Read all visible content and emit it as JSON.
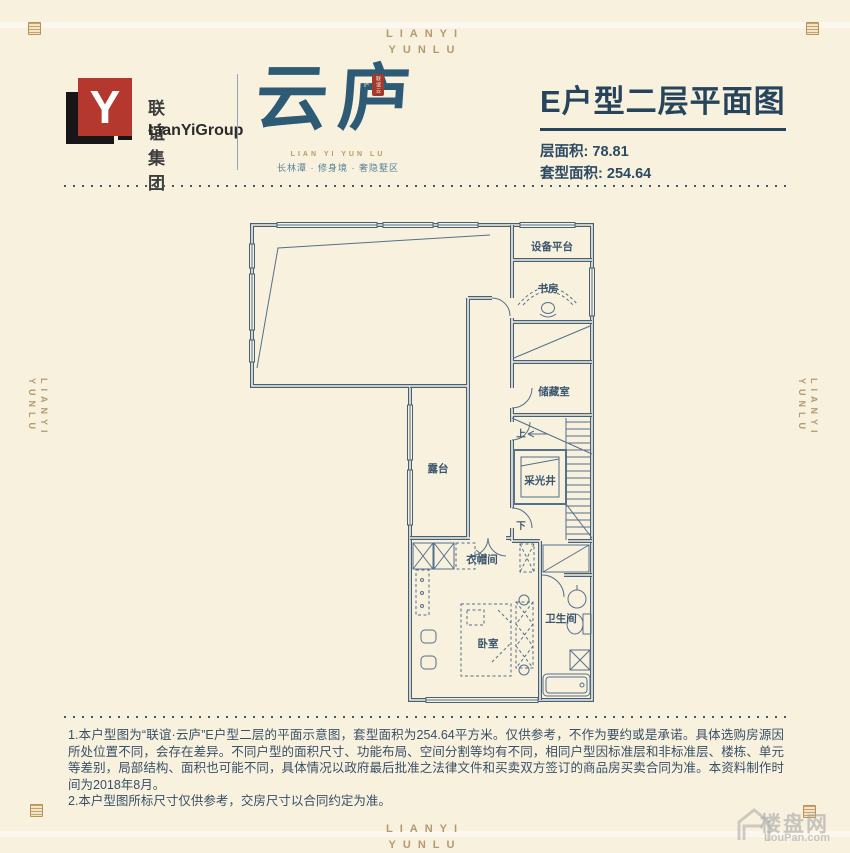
{
  "colors": {
    "background": "#f8f1de",
    "plan_ink": "#44607b",
    "title_blue": "#26445c",
    "gold": "#b6955e",
    "logo_red": "#b5382e",
    "seal_red": "#a23a30"
  },
  "banner": {
    "line1": "LIANYI",
    "line2": "YUNLU"
  },
  "header": {
    "logo": {
      "mark_letter": "Y",
      "company_cn": "联谊集团",
      "company_en": "LianYiGroup"
    },
    "brand": {
      "name": "云庐",
      "seal": "联谊云庐",
      "latin": "LIAN YI YUN LU",
      "tagline": "长林潭 · 修身境 · 奢隐墅区"
    },
    "plan_title": "E户型二层平面图",
    "areas": {
      "floor_label": "层面积:",
      "floor_value": "78.81",
      "unit_label": "套型面积:",
      "unit_value": "254.64"
    }
  },
  "floorplan": {
    "rooms": {
      "equipment_platform": "设备平台",
      "study": "书房",
      "storage": "储藏室",
      "stairs_up": "上",
      "light_well": "采光井",
      "stairs_down": "下",
      "terrace": "露台",
      "cloakroom": "衣帽间",
      "bedroom": "卧室",
      "bathroom": "卫生间"
    }
  },
  "disclaimer": {
    "line1": "1.本户型图为“联谊·云庐”E户型二层的平面示意图，套型面积为254.64平方米。仅供参考，不作为要约或是承诺。具体选购房源因所处位置不同，会存在差异。不同户型的面积尺寸、功能布局、空间分割等均有不同，相同户型因标准层和非标准层、楼栋、单元等差别，局部结构、面积也可能不同，具体情况以政府最后批准之法律文件和买卖双方签订的商品房买卖合同为准。本资料制作时间为2018年8月。",
    "line2": "2.本户型图所标尺寸仅供参考，交房尺寸以合同约定为准。"
  },
  "watermark": {
    "site_cn": "楼盘网",
    "site_en": "LouPan.com"
  }
}
